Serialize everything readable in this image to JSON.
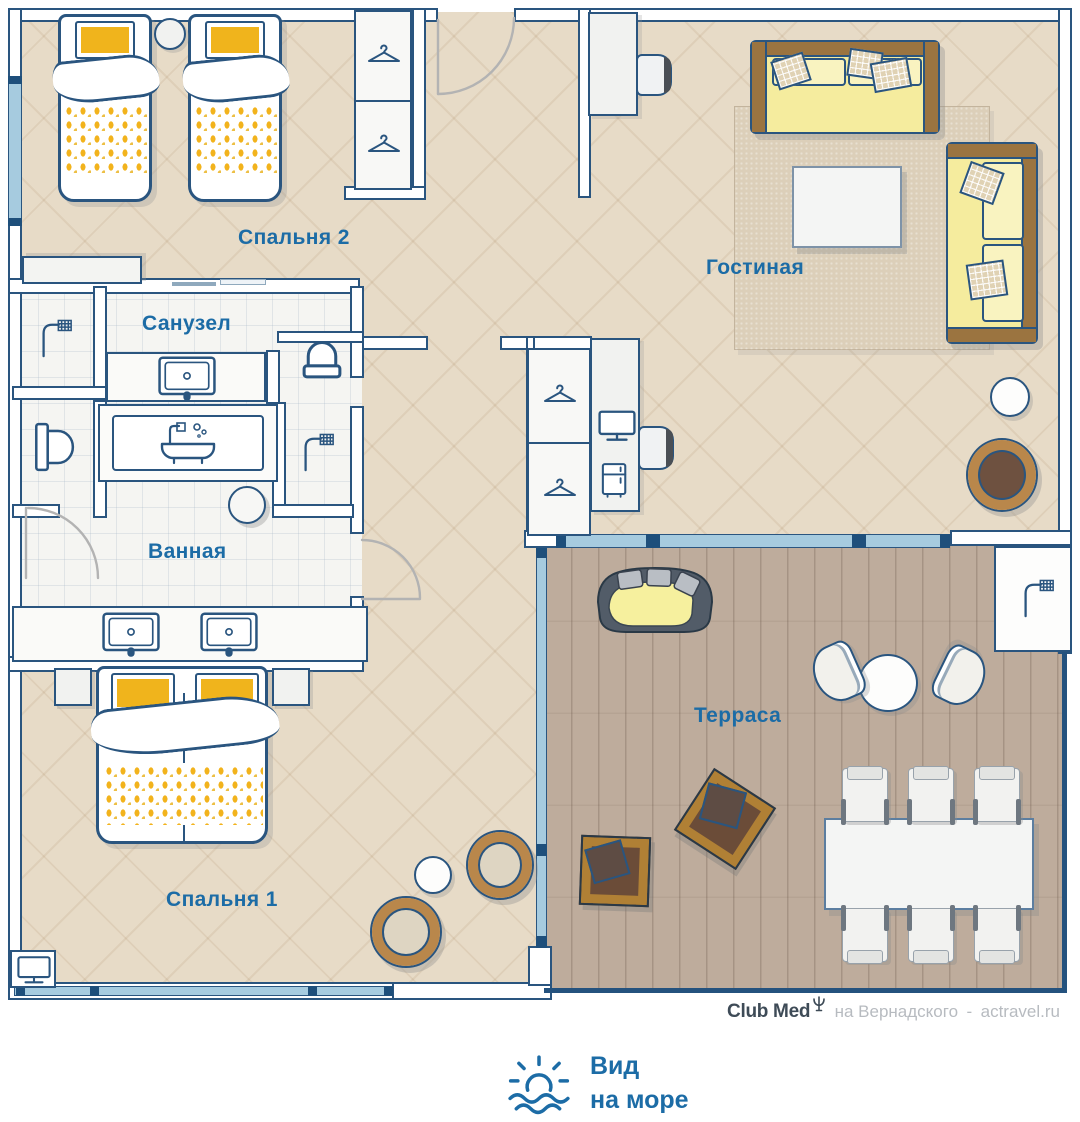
{
  "rooms": {
    "bedroom2": "Спальня 2",
    "living": "Гостиная",
    "wc": "Санузел",
    "bath": "Ванная",
    "bedroom1": "Спальня 1",
    "terrace": "Терраса"
  },
  "footer": {
    "brand": "Club Med",
    "location": "на Вернадского",
    "separator": "-",
    "site": "actravel.ru"
  },
  "view": {
    "line1": "Вид",
    "line2": "на море"
  },
  "palette": {
    "label_blue": "#1c6ca6",
    "wall_blue": "#2a557f",
    "glass_blue": "#a6cbdf",
    "floor_beige": "#e7dbc7",
    "floor_wood": "#beac9c",
    "accent_yellow": "#f0b41c",
    "sofa_yellow": "#f5ec9e",
    "basket_brown": "#b9874b"
  },
  "icons": [
    "shower-icon",
    "hanger-icon",
    "sink-icon",
    "toilet-icon",
    "bathtub-icon",
    "tv-icon",
    "minibar-icon",
    "sun-sea-icon",
    "trident-icon"
  ]
}
